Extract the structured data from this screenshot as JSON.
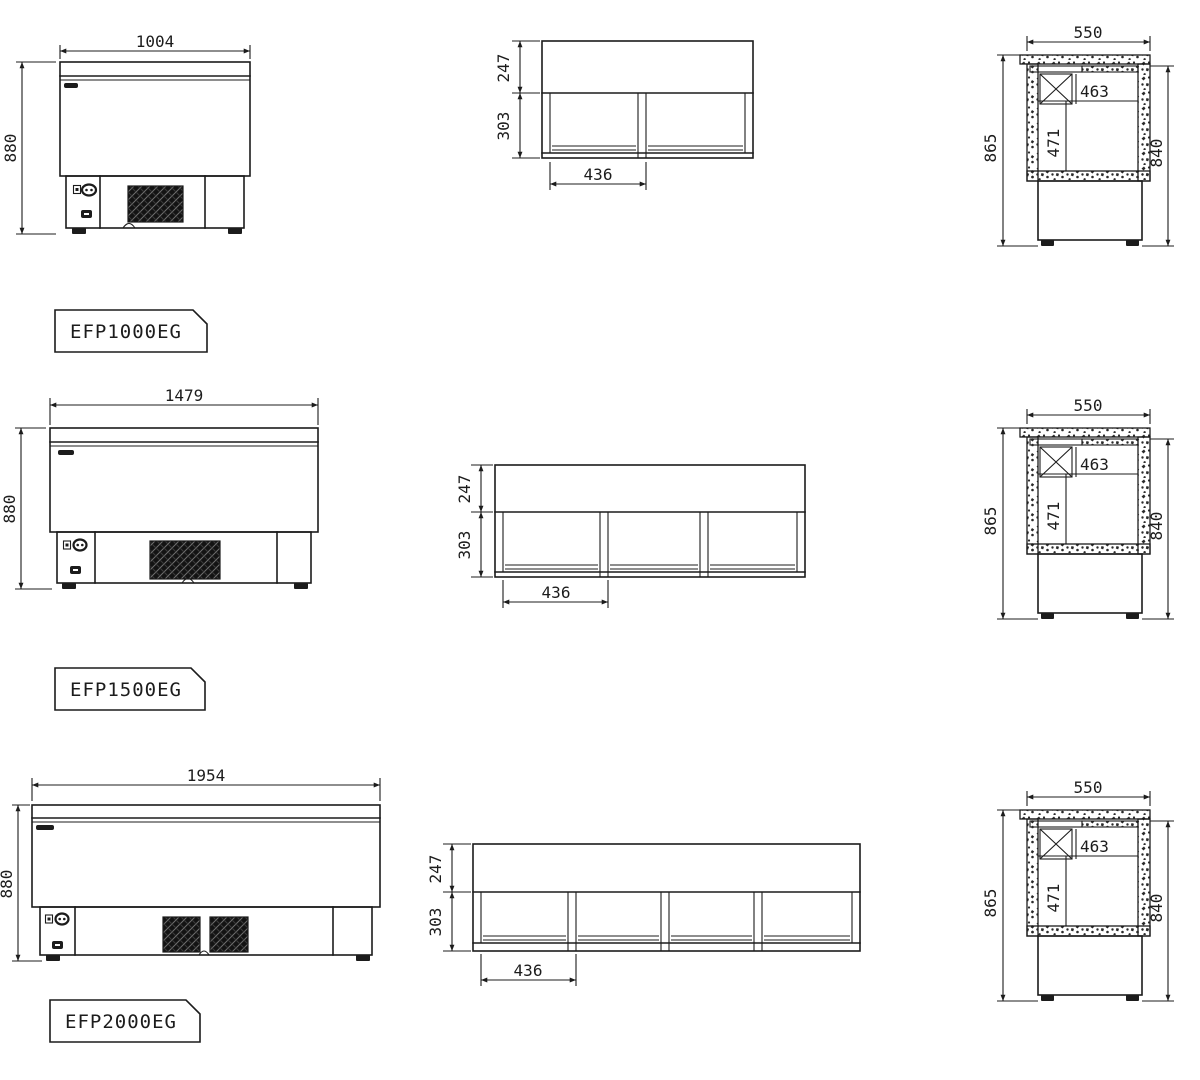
{
  "sheet": {
    "background": "#ffffff",
    "line_color": "#1c1c1c",
    "units": "mm"
  },
  "models": [
    {
      "label": "EFP1000EG",
      "front_view": {
        "overall_width": "1004",
        "overall_height": "880"
      },
      "plan_view": {
        "lid_depth": "247",
        "well_depth": "303",
        "basket_width": "436",
        "compartment_count": 2
      },
      "side_view": {
        "overall_depth": "550",
        "inner_width": "463",
        "inner_depth": "471",
        "height_with_lid": "865",
        "body_height": "840"
      }
    },
    {
      "label": "EFP1500EG",
      "front_view": {
        "overall_width": "1479",
        "overall_height": "880"
      },
      "plan_view": {
        "lid_depth": "247",
        "well_depth": "303",
        "basket_width": "436",
        "compartment_count": 3
      },
      "side_view": {
        "overall_depth": "550",
        "inner_width": "463",
        "inner_depth": "471",
        "height_with_lid": "865",
        "body_height": "840"
      }
    },
    {
      "label": "EFP2000EG",
      "front_view": {
        "overall_width": "1954",
        "overall_height": "880"
      },
      "plan_view": {
        "lid_depth": "247",
        "well_depth": "303",
        "basket_width": "436",
        "compartment_count": 4
      },
      "side_view": {
        "overall_depth": "550",
        "inner_width": "463",
        "inner_depth": "471",
        "height_with_lid": "865",
        "body_height": "840"
      }
    }
  ]
}
